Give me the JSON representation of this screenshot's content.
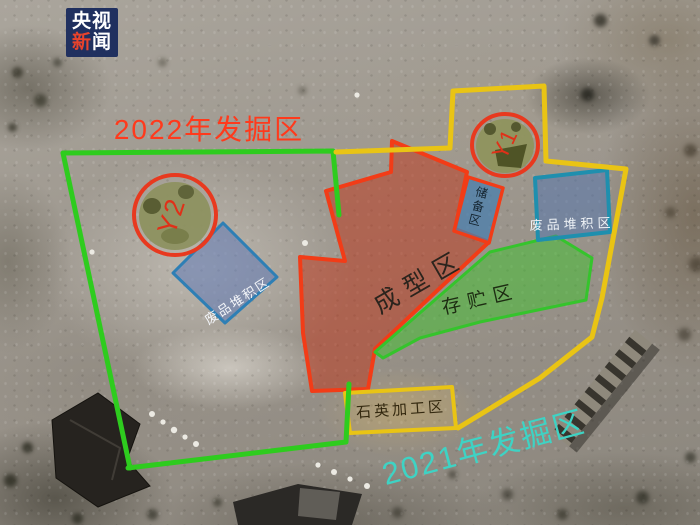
{
  "logo": {
    "line1": "央视",
    "line2_red": "新",
    "line2_white": "闻"
  },
  "areas": {
    "area_2022": {
      "label": "2022年发掘区",
      "text_color": "#ff3a1c",
      "line_color": "#2ecc1e"
    },
    "area_2021": {
      "label": "2021年发掘区",
      "text_color": "#3ed3c4",
      "line_color": "#e9c414"
    }
  },
  "zones": {
    "forming": {
      "label": "成型区",
      "outline": "#f23c17",
      "fill": "#c03418"
    },
    "storage": {
      "label": "存贮区",
      "outline": "#35c42c",
      "fill": "#3fc32e"
    },
    "waste_left": {
      "label": "废品堆积区",
      "outline": "#2e7fb5",
      "fill": "#5f78b4"
    },
    "waste_right": {
      "label": "废品堆积区",
      "outline": "#1f8fae",
      "fill": "#4f74b0"
    },
    "quartz": {
      "label": "石英加工区",
      "outline": "#e9c414"
    },
    "reserve": {
      "label": "储备区",
      "outline": "#f23c17",
      "fill": "#4a7fae"
    }
  },
  "pits": {
    "marker_color": "#e8391f",
    "y2": {
      "label": "Y2"
    },
    "y1": {
      "label": "Y1"
    }
  }
}
